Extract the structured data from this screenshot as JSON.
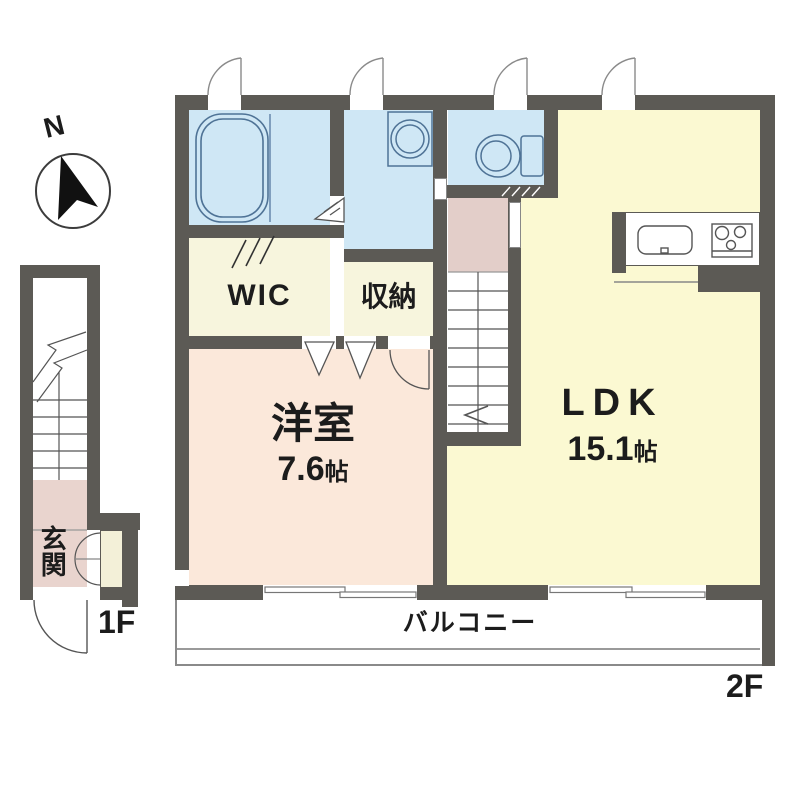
{
  "compass": {
    "north_label": "N"
  },
  "floor_labels": {
    "ground": "1F",
    "upper": "2F"
  },
  "rooms": {
    "ldk": {
      "name": "LDK",
      "size_value": "15.1",
      "size_unit": "帖"
    },
    "western_room": {
      "name": "洋室",
      "size_value": "7.6",
      "size_unit": "帖"
    },
    "wic": {
      "name": "WIC"
    },
    "storage": {
      "name": "収納"
    },
    "entrance": {
      "name": "玄関"
    },
    "balcony": {
      "name": "バルコニー"
    }
  },
  "colors": {
    "wall": "#5c5a55",
    "wet_rooms": "#cfe7f5",
    "ldk_floor": "#fbf9d2",
    "closet_floor": "#f7f5dd",
    "western_floor": "#fbe8da",
    "hall_floor": "#e3cec9",
    "fixture_outline": "#4f7396"
  }
}
